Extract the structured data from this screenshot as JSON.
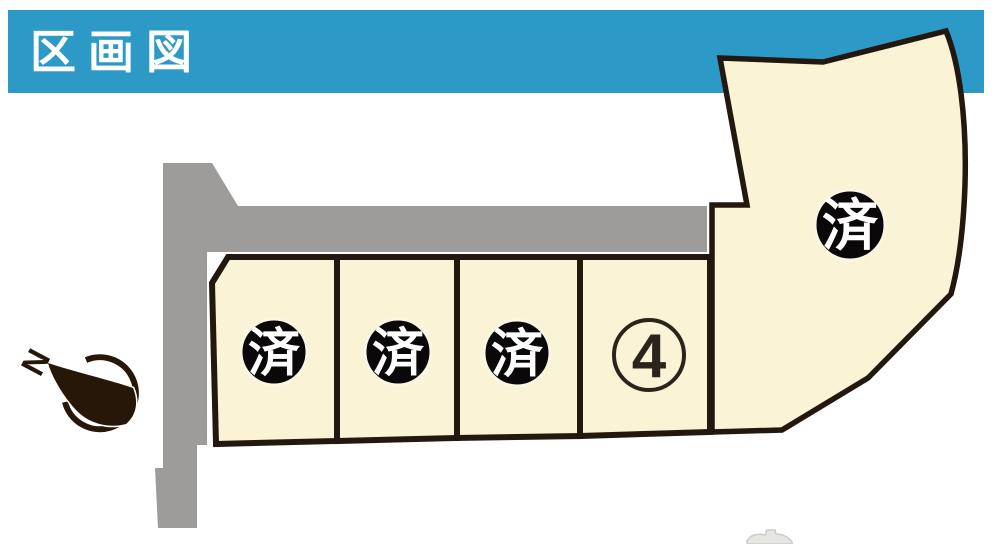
{
  "header": {
    "title": "区画図",
    "bg_color": "#2D99C7",
    "text_color": "#FFFFFF"
  },
  "site_plan": {
    "colors": {
      "lot_fill": "#FAF3D5",
      "road_fill": "#9D9C9A",
      "outline": "#22180F",
      "sold_badge_bg": "#0A0808",
      "sold_badge_text": "#FFFFFF",
      "available_circle": "#2B241C",
      "compass": "#261708"
    },
    "lots": [
      {
        "id": "lot-1",
        "status": "sold",
        "badge": "済"
      },
      {
        "id": "lot-2",
        "status": "sold",
        "badge": "済"
      },
      {
        "id": "lot-3",
        "status": "sold",
        "badge": "済"
      },
      {
        "id": "lot-4",
        "status": "available",
        "number": "4"
      },
      {
        "id": "lot-5",
        "status": "sold",
        "badge": "済"
      }
    ],
    "compass": {
      "label": "N"
    }
  }
}
